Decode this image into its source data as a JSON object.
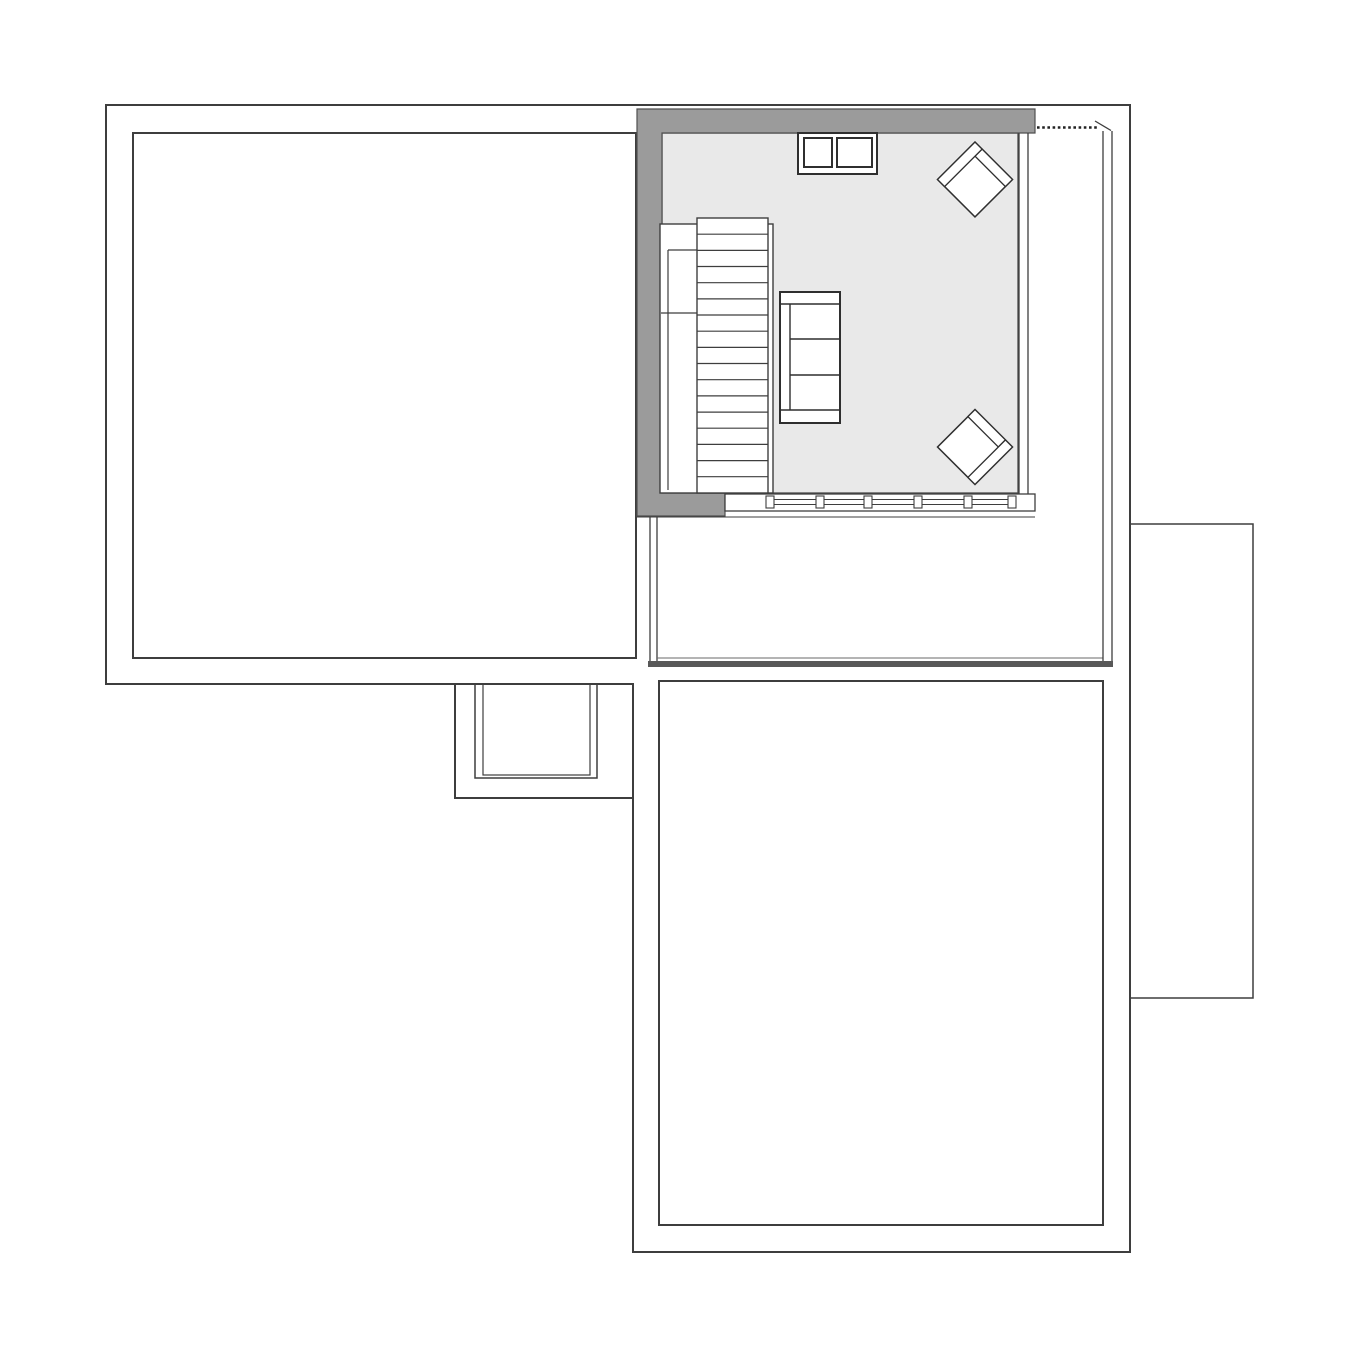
{
  "canvas": {
    "w": 1360,
    "h": 1360,
    "background": "#ffffff"
  },
  "palette": {
    "line": "#3e3e3e",
    "line_soft": "#4a4a4a",
    "wall_fill": "#9b9b9b",
    "floor_fill": "#e9e9e9",
    "thick_edge": "#585858",
    "white": "#ffffff"
  },
  "legend": {
    "drawing_type": "floor-plan",
    "rooms": [
      "left-room",
      "living-room",
      "terrace",
      "lower-room",
      "right-annex",
      "porch"
    ],
    "furniture": [
      "staircase",
      "sofa",
      "armchair-top",
      "armchair-bottom",
      "chimney-block",
      "window-band"
    ]
  },
  "elements": [
    {
      "name": "left-room-outline",
      "tag": "rect",
      "attrs": {
        "x": 133,
        "y": 133,
        "width": 503,
        "height": 525,
        "fill": "#ffffff",
        "stroke": "#3e3e3e",
        "stroke-width": 2
      }
    },
    {
      "name": "lower-room-outline",
      "tag": "rect",
      "attrs": {
        "x": 659,
        "y": 681,
        "width": 444,
        "height": 544,
        "fill": "#ffffff",
        "stroke": "#3e3e3e",
        "stroke-width": 2
      }
    },
    {
      "name": "right-annex-outline",
      "tag": "rect",
      "attrs": {
        "x": 1130,
        "y": 524,
        "width": 123,
        "height": 474,
        "fill": "#ffffff",
        "stroke": "#3e3e3e",
        "stroke-width": 1.5
      }
    },
    {
      "name": "porch-inner-rect-outer",
      "tag": "rect",
      "attrs": {
        "x": 475,
        "y": 684,
        "width": 122,
        "height": 94,
        "fill": "#ffffff",
        "stroke": "#3e3e3e",
        "stroke-width": 1.5
      }
    },
    {
      "name": "porch-inner-rect-inner",
      "tag": "rect",
      "attrs": {
        "x": 483,
        "y": 684,
        "width": 107,
        "height": 91,
        "fill": "none",
        "stroke": "#3e3e3e",
        "stroke-width": 1.2
      }
    },
    {
      "name": "building-outline",
      "tag": "path",
      "attrs": {
        "d": "M106,105 L1130,105 L1130,1252 L633,1252 L633,684 L106,684 Z M455,684 L455,798 L633,798",
        "fill": "none",
        "stroke": "#3e3e3e",
        "stroke-width": 2
      }
    },
    {
      "name": "terrace-left-wall-outer",
      "tag": "line",
      "attrs": {
        "x1": 650,
        "y1": 517,
        "x2": 650,
        "y2": 661,
        "stroke": "#3e3e3e",
        "stroke-width": 1.3
      }
    },
    {
      "name": "terrace-left-wall-inner",
      "tag": "line",
      "attrs": {
        "x1": 657,
        "y1": 517,
        "x2": 657,
        "y2": 661,
        "stroke": "#3e3e3e",
        "stroke-width": 1.3
      }
    },
    {
      "name": "terrace-bottom-thin-line",
      "tag": "line",
      "attrs": {
        "x1": 657,
        "y1": 658,
        "x2": 1103,
        "y2": 658,
        "stroke": "#6a6a6a",
        "stroke-width": 1
      }
    },
    {
      "name": "terrace-bottom-thick-edge",
      "tag": "rect",
      "attrs": {
        "x": 648,
        "y": 661,
        "width": 465,
        "height": 6,
        "fill": "#585858"
      }
    },
    {
      "name": "terrace-right-wall-inner",
      "tag": "line",
      "attrs": {
        "x1": 1103,
        "y1": 131,
        "x2": 1103,
        "y2": 661,
        "stroke": "#3e3e3e",
        "stroke-width": 1.3
      }
    },
    {
      "name": "terrace-right-wall-outer",
      "tag": "line",
      "attrs": {
        "x1": 1112,
        "y1": 131,
        "x2": 1112,
        "y2": 661,
        "stroke": "#3e3e3e",
        "stroke-width": 1.3
      }
    },
    {
      "name": "eave-dashed-line",
      "tag": "line",
      "attrs": {
        "x1": 1037,
        "y1": 127.5,
        "x2": 1097,
        "y2": 127.5,
        "stroke": "#222222",
        "stroke-width": 2.6,
        "stroke-dasharray": "2.6 2.6"
      }
    },
    {
      "name": "eave-diagonal-tick",
      "tag": "line",
      "attrs": {
        "x1": 1095,
        "y1": 121,
        "x2": 1111,
        "y2": 130.5,
        "stroke": "#3e3e3e",
        "stroke-width": 1.3
      }
    },
    {
      "name": "living-room-floor",
      "tag": "rect",
      "attrs": {
        "x": 662,
        "y": 133,
        "width": 356,
        "height": 360,
        "fill": "#e9e9e9",
        "stroke": "#4a4a4a",
        "stroke-width": 1.3
      }
    },
    {
      "name": "living-room-gray-wall",
      "tag": "polygon",
      "attrs": {
        "points": "637,109 1035,109 1035,133 662,133 662,493 725,493 725,516 637,516",
        "fill": "#9b9b9b",
        "stroke": "#4f4f4f",
        "stroke-width": 1.2
      }
    },
    {
      "name": "living-room-right-wall-line-a",
      "tag": "line",
      "attrs": {
        "x1": 1019,
        "y1": 133,
        "x2": 1019,
        "y2": 511,
        "stroke": "#3e3e3e",
        "stroke-width": 1.3
      }
    },
    {
      "name": "living-room-right-wall-line-b",
      "tag": "line",
      "attrs": {
        "x1": 1028,
        "y1": 133,
        "x2": 1028,
        "y2": 511,
        "stroke": "#3e3e3e",
        "stroke-width": 1.3
      }
    },
    {
      "name": "window-band",
      "tag": "rect",
      "attrs": {
        "x": 725,
        "y": 494,
        "width": 310,
        "height": 17,
        "fill": "#ffffff",
        "stroke": "#3e3e3e",
        "stroke-width": 1.3
      }
    },
    {
      "name": "window-sill-line",
      "tag": "line",
      "attrs": {
        "x1": 637,
        "y1": 517,
        "x2": 1035,
        "y2": 517,
        "stroke": "#3e3e3e",
        "stroke-width": 1
      }
    },
    {
      "name": "window-glazing-line-a",
      "tag": "line",
      "attrs": {
        "x1": 770,
        "y1": 499.5,
        "x2": 1012,
        "y2": 499.5,
        "stroke": "#3e3e3e",
        "stroke-width": 1.1
      }
    },
    {
      "name": "window-glazing-line-b",
      "tag": "line",
      "attrs": {
        "x1": 770,
        "y1": 504.5,
        "x2": 1012,
        "y2": 504.5,
        "stroke": "#3e3e3e",
        "stroke-width": 1.1
      }
    },
    {
      "name": "window-mullion-1",
      "tag": "rect",
      "attrs": {
        "x": 766,
        "y": 496,
        "width": 8,
        "height": 12,
        "fill": "#ffffff",
        "stroke": "#3e3e3e",
        "stroke-width": 1.1
      }
    },
    {
      "name": "window-mullion-2",
      "tag": "rect",
      "attrs": {
        "x": 816,
        "y": 496,
        "width": 8,
        "height": 12,
        "fill": "#ffffff",
        "stroke": "#3e3e3e",
        "stroke-width": 1.1
      }
    },
    {
      "name": "window-mullion-3",
      "tag": "rect",
      "attrs": {
        "x": 864,
        "y": 496,
        "width": 8,
        "height": 12,
        "fill": "#ffffff",
        "stroke": "#3e3e3e",
        "stroke-width": 1.1
      }
    },
    {
      "name": "window-mullion-4",
      "tag": "rect",
      "attrs": {
        "x": 914,
        "y": 496,
        "width": 8,
        "height": 12,
        "fill": "#ffffff",
        "stroke": "#3e3e3e",
        "stroke-width": 1.1
      }
    },
    {
      "name": "window-mullion-5",
      "tag": "rect",
      "attrs": {
        "x": 964,
        "y": 496,
        "width": 8,
        "height": 12,
        "fill": "#ffffff",
        "stroke": "#3e3e3e",
        "stroke-width": 1.1
      }
    },
    {
      "name": "window-mullion-6",
      "tag": "rect",
      "attrs": {
        "x": 1008,
        "y": 496,
        "width": 8,
        "height": 12,
        "fill": "#ffffff",
        "stroke": "#3e3e3e",
        "stroke-width": 1.1
      }
    },
    {
      "name": "staircase-outer-box",
      "tag": "rect",
      "attrs": {
        "x": 660,
        "y": 224,
        "width": 113,
        "height": 269,
        "fill": "#ffffff",
        "stroke": "#3e3e3e",
        "stroke-width": 1.4
      }
    },
    {
      "name": "staircase-treads-box",
      "tag": "rect",
      "attrs": {
        "x": 697,
        "y": 218,
        "width": 71,
        "height": 275,
        "fill": "#ffffff",
        "stroke": "#3e3e3e",
        "stroke-width": 1.4
      }
    },
    {
      "name": "stair-tread-1",
      "tag": "line",
      "attrs": {
        "x1": 697,
        "y1": 234.2,
        "x2": 768,
        "y2": 234.2,
        "stroke": "#3e3e3e",
        "stroke-width": 1.2
      }
    },
    {
      "name": "stair-tread-2",
      "tag": "line",
      "attrs": {
        "x1": 697,
        "y1": 250.4,
        "x2": 768,
        "y2": 250.4,
        "stroke": "#3e3e3e",
        "stroke-width": 1.2
      }
    },
    {
      "name": "stair-tread-3",
      "tag": "line",
      "attrs": {
        "x1": 697,
        "y1": 266.5,
        "x2": 768,
        "y2": 266.5,
        "stroke": "#3e3e3e",
        "stroke-width": 1.2
      }
    },
    {
      "name": "stair-tread-4",
      "tag": "line",
      "attrs": {
        "x1": 697,
        "y1": 282.7,
        "x2": 768,
        "y2": 282.7,
        "stroke": "#3e3e3e",
        "stroke-width": 1.2
      }
    },
    {
      "name": "stair-tread-5",
      "tag": "line",
      "attrs": {
        "x1": 697,
        "y1": 298.9,
        "x2": 768,
        "y2": 298.9,
        "stroke": "#3e3e3e",
        "stroke-width": 1.2
      }
    },
    {
      "name": "stair-tread-6",
      "tag": "line",
      "attrs": {
        "x1": 697,
        "y1": 315.0,
        "x2": 768,
        "y2": 315.0,
        "stroke": "#3e3e3e",
        "stroke-width": 1.2
      }
    },
    {
      "name": "stair-tread-7",
      "tag": "line",
      "attrs": {
        "x1": 697,
        "y1": 331.2,
        "x2": 768,
        "y2": 331.2,
        "stroke": "#3e3e3e",
        "stroke-width": 1.2
      }
    },
    {
      "name": "stair-tread-8",
      "tag": "line",
      "attrs": {
        "x1": 697,
        "y1": 347.4,
        "x2": 768,
        "y2": 347.4,
        "stroke": "#3e3e3e",
        "stroke-width": 1.2
      }
    },
    {
      "name": "stair-tread-9",
      "tag": "line",
      "attrs": {
        "x1": 697,
        "y1": 363.5,
        "x2": 768,
        "y2": 363.5,
        "stroke": "#3e3e3e",
        "stroke-width": 1.2
      }
    },
    {
      "name": "stair-tread-10",
      "tag": "line",
      "attrs": {
        "x1": 697,
        "y1": 379.7,
        "x2": 768,
        "y2": 379.7,
        "stroke": "#3e3e3e",
        "stroke-width": 1.2
      }
    },
    {
      "name": "stair-tread-11",
      "tag": "line",
      "attrs": {
        "x1": 697,
        "y1": 395.9,
        "x2": 768,
        "y2": 395.9,
        "stroke": "#3e3e3e",
        "stroke-width": 1.2
      }
    },
    {
      "name": "stair-tread-12",
      "tag": "line",
      "attrs": {
        "x1": 697,
        "y1": 412.1,
        "x2": 768,
        "y2": 412.1,
        "stroke": "#3e3e3e",
        "stroke-width": 1.2
      }
    },
    {
      "name": "stair-tread-13",
      "tag": "line",
      "attrs": {
        "x1": 697,
        "y1": 428.2,
        "x2": 768,
        "y2": 428.2,
        "stroke": "#3e3e3e",
        "stroke-width": 1.2
      }
    },
    {
      "name": "stair-tread-14",
      "tag": "line",
      "attrs": {
        "x1": 697,
        "y1": 444.4,
        "x2": 768,
        "y2": 444.4,
        "stroke": "#3e3e3e",
        "stroke-width": 1.2
      }
    },
    {
      "name": "stair-tread-15",
      "tag": "line",
      "attrs": {
        "x1": 697,
        "y1": 460.6,
        "x2": 768,
        "y2": 460.6,
        "stroke": "#3e3e3e",
        "stroke-width": 1.2
      }
    },
    {
      "name": "stair-tread-16",
      "tag": "line",
      "attrs": {
        "x1": 697,
        "y1": 476.7,
        "x2": 768,
        "y2": 476.7,
        "stroke": "#3e3e3e",
        "stroke-width": 1.2
      }
    },
    {
      "name": "stair-rail-top",
      "tag": "line",
      "attrs": {
        "x1": 668,
        "y1": 250,
        "x2": 697,
        "y2": 250,
        "stroke": "#3e3e3e",
        "stroke-width": 1.2
      }
    },
    {
      "name": "stair-rail-side",
      "tag": "line",
      "attrs": {
        "x1": 668,
        "y1": 250,
        "x2": 668,
        "y2": 490,
        "stroke": "#3e3e3e",
        "stroke-width": 1.2
      }
    },
    {
      "name": "stair-rail-divider",
      "tag": "line",
      "attrs": {
        "x1": 661,
        "y1": 313,
        "x2": 697,
        "y2": 313,
        "stroke": "#3e3e3e",
        "stroke-width": 1.2
      }
    },
    {
      "name": "sofa-outline",
      "tag": "rect",
      "attrs": {
        "x": 780,
        "y": 292,
        "width": 60,
        "height": 131,
        "fill": "#ffffff",
        "stroke": "#2f2f2f",
        "stroke-width": 2
      }
    },
    {
      "name": "sofa-armrest-top-line",
      "tag": "line",
      "attrs": {
        "x1": 780,
        "y1": 304,
        "x2": 840,
        "y2": 304,
        "stroke": "#2f2f2f",
        "stroke-width": 1.4
      }
    },
    {
      "name": "sofa-armrest-bottom-line",
      "tag": "line",
      "attrs": {
        "x1": 780,
        "y1": 410,
        "x2": 840,
        "y2": 410,
        "stroke": "#2f2f2f",
        "stroke-width": 1.4
      }
    },
    {
      "name": "sofa-backrest-line",
      "tag": "line",
      "attrs": {
        "x1": 790,
        "y1": 304,
        "x2": 790,
        "y2": 410,
        "stroke": "#2f2f2f",
        "stroke-width": 1.4
      }
    },
    {
      "name": "sofa-cushion-line-1",
      "tag": "line",
      "attrs": {
        "x1": 790,
        "y1": 339,
        "x2": 840,
        "y2": 339,
        "stroke": "#2f2f2f",
        "stroke-width": 1.4
      }
    },
    {
      "name": "sofa-cushion-line-2",
      "tag": "line",
      "attrs": {
        "x1": 790,
        "y1": 375,
        "x2": 840,
        "y2": 375,
        "stroke": "#2f2f2f",
        "stroke-width": 1.4
      }
    },
    {
      "name": "chimney-block",
      "tag": "rect",
      "attrs": {
        "x": 798,
        "y": 133,
        "width": 79,
        "height": 41,
        "fill": "#ffffff",
        "stroke": "#2f2f2f",
        "stroke-width": 2
      }
    },
    {
      "name": "chimney-flue-left",
      "tag": "rect",
      "attrs": {
        "x": 804,
        "y": 138,
        "width": 28,
        "height": 29,
        "fill": "#ffffff",
        "stroke": "#2f2f2f",
        "stroke-width": 2
      }
    },
    {
      "name": "chimney-flue-right",
      "tag": "rect",
      "attrs": {
        "x": 837,
        "y": 138,
        "width": 35,
        "height": 29,
        "fill": "#ffffff",
        "stroke": "#2f2f2f",
        "stroke-width": 2
      }
    },
    {
      "name": "armchair-top-outline",
      "tag": "rect",
      "attrs": {
        "x": 948.5,
        "y": 153,
        "width": 53,
        "height": 53,
        "fill": "#ffffff",
        "stroke": "#2f2f2f",
        "stroke-width": 1.5,
        "transform": "rotate(45 975 179.5)"
      }
    },
    {
      "name": "armchair-top-back-band",
      "tag": "rect",
      "attrs": {
        "x": 958.5,
        "y": 153,
        "width": 43,
        "height": 10,
        "fill": "#ffffff",
        "stroke": "#2f2f2f",
        "stroke-width": 1.3,
        "transform": "rotate(45 975 179.5)"
      }
    },
    {
      "name": "armchair-top-arm-band",
      "tag": "rect",
      "attrs": {
        "x": 948.5,
        "y": 153,
        "width": 10,
        "height": 53,
        "fill": "#ffffff",
        "stroke": "#2f2f2f",
        "stroke-width": 1.3,
        "transform": "rotate(45 975 179.5)"
      }
    },
    {
      "name": "armchair-bottom-outline",
      "tag": "rect",
      "attrs": {
        "x": 948.5,
        "y": 420.5,
        "width": 53,
        "height": 53,
        "fill": "#ffffff",
        "stroke": "#2f2f2f",
        "stroke-width": 1.5,
        "transform": "rotate(45 975 447)"
      }
    },
    {
      "name": "armchair-bottom-back-band",
      "tag": "rect",
      "attrs": {
        "x": 948.5,
        "y": 420.5,
        "width": 43,
        "height": 10,
        "fill": "#ffffff",
        "stroke": "#2f2f2f",
        "stroke-width": 1.3,
        "transform": "rotate(45 975 447)"
      }
    },
    {
      "name": "armchair-bottom-arm-band",
      "tag": "rect",
      "attrs": {
        "x": 991.5,
        "y": 420.5,
        "width": 10,
        "height": 53,
        "fill": "#ffffff",
        "stroke": "#2f2f2f",
        "stroke-width": 1.3,
        "transform": "rotate(45 975 447)"
      }
    }
  ]
}
